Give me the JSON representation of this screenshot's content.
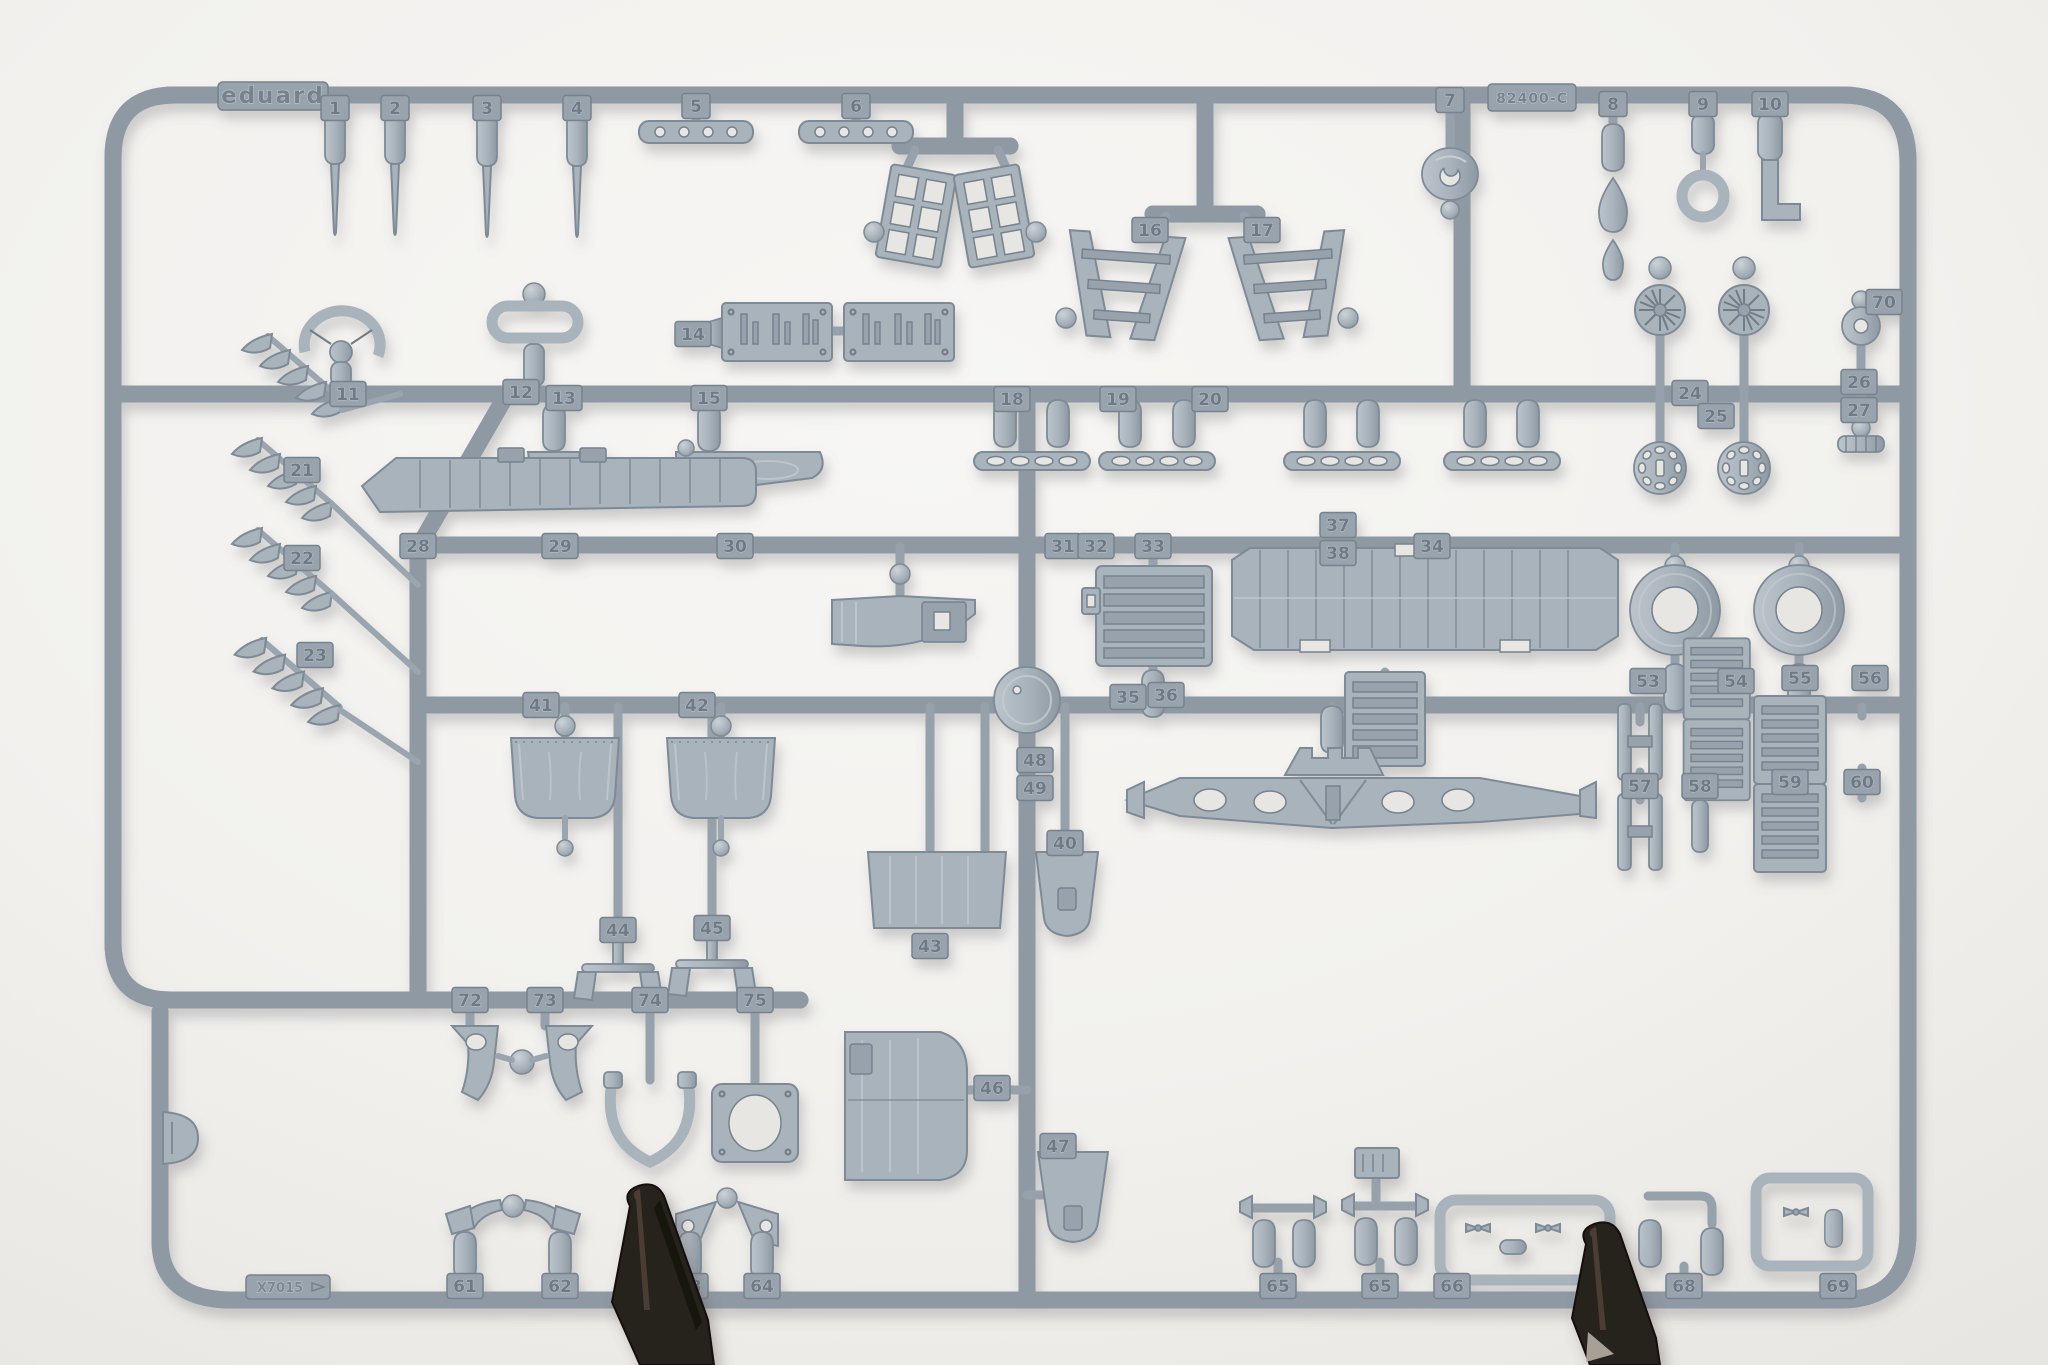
{
  "photo": {
    "background_color": "#f3f2ef",
    "plastic_color": "#a9b3bc",
    "plastic_dark": "#7e8a95",
    "plastic_light": "#c6cdd3",
    "tag_color": "#98a3ad",
    "clip_color": "#26201c"
  },
  "markings": {
    "brand": "eduard",
    "code": "82400-C",
    "mold": "X7015"
  },
  "part_tags": [
    {
      "label": "1",
      "x": 335,
      "y": 108
    },
    {
      "label": "2",
      "x": 395,
      "y": 108
    },
    {
      "label": "3",
      "x": 487,
      "y": 108
    },
    {
      "label": "4",
      "x": 577,
      "y": 108
    },
    {
      "label": "5",
      "x": 696,
      "y": 106
    },
    {
      "label": "6",
      "x": 856,
      "y": 106
    },
    {
      "label": "16",
      "x": 1150,
      "y": 230
    },
    {
      "label": "17",
      "x": 1262,
      "y": 230
    },
    {
      "label": "7",
      "x": 1450,
      "y": 100
    },
    {
      "label": "8",
      "x": 1613,
      "y": 104
    },
    {
      "label": "9",
      "x": 1703,
      "y": 104
    },
    {
      "label": "10",
      "x": 1770,
      "y": 104
    },
    {
      "label": "11",
      "x": 348,
      "y": 394
    },
    {
      "label": "12",
      "x": 521,
      "y": 392
    },
    {
      "label": "13",
      "x": 564,
      "y": 398
    },
    {
      "label": "14",
      "x": 693,
      "y": 334
    },
    {
      "label": "15",
      "x": 709,
      "y": 398
    },
    {
      "label": "18",
      "x": 1012,
      "y": 399
    },
    {
      "label": "19",
      "x": 1118,
      "y": 399
    },
    {
      "label": "20",
      "x": 1210,
      "y": 399
    },
    {
      "label": "24",
      "x": 1690,
      "y": 393
    },
    {
      "label": "25",
      "x": 1716,
      "y": 416
    },
    {
      "label": "26",
      "x": 1859,
      "y": 382
    },
    {
      "label": "27",
      "x": 1859,
      "y": 410
    },
    {
      "label": "70",
      "x": 1884,
      "y": 302
    },
    {
      "label": "21",
      "x": 302,
      "y": 470
    },
    {
      "label": "22",
      "x": 302,
      "y": 558
    },
    {
      "label": "23",
      "x": 315,
      "y": 655
    },
    {
      "label": "28",
      "x": 418,
      "y": 546
    },
    {
      "label": "29",
      "x": 560,
      "y": 546
    },
    {
      "label": "30",
      "x": 735,
      "y": 546
    },
    {
      "label": "31",
      "x": 1063,
      "y": 546
    },
    {
      "label": "32",
      "x": 1096,
      "y": 546
    },
    {
      "label": "33",
      "x": 1153,
      "y": 546
    },
    {
      "label": "34",
      "x": 1432,
      "y": 546
    },
    {
      "label": "37",
      "x": 1338,
      "y": 525
    },
    {
      "label": "38",
      "x": 1338,
      "y": 553
    },
    {
      "label": "41",
      "x": 541,
      "y": 705
    },
    {
      "label": "42",
      "x": 697,
      "y": 705
    },
    {
      "label": "35",
      "x": 1128,
      "y": 697
    },
    {
      "label": "36",
      "x": 1166,
      "y": 695
    },
    {
      "label": "53",
      "x": 1648,
      "y": 681
    },
    {
      "label": "54",
      "x": 1736,
      "y": 681
    },
    {
      "label": "55",
      "x": 1800,
      "y": 678
    },
    {
      "label": "56",
      "x": 1870,
      "y": 678
    },
    {
      "label": "57",
      "x": 1640,
      "y": 786
    },
    {
      "label": "58",
      "x": 1700,
      "y": 786
    },
    {
      "label": "59",
      "x": 1790,
      "y": 782
    },
    {
      "label": "60",
      "x": 1862,
      "y": 782
    },
    {
      "label": "48",
      "x": 1035,
      "y": 760
    },
    {
      "label": "49",
      "x": 1035,
      "y": 788
    },
    {
      "label": "44",
      "x": 618,
      "y": 930
    },
    {
      "label": "45",
      "x": 712,
      "y": 928
    },
    {
      "label": "40",
      "x": 1065,
      "y": 843
    },
    {
      "label": "43",
      "x": 930,
      "y": 946
    },
    {
      "label": "46",
      "x": 992,
      "y": 1088
    },
    {
      "label": "47",
      "x": 1058,
      "y": 1146
    },
    {
      "label": "72",
      "x": 470,
      "y": 1000
    },
    {
      "label": "73",
      "x": 545,
      "y": 1000
    },
    {
      "label": "74",
      "x": 650,
      "y": 1000
    },
    {
      "label": "75",
      "x": 755,
      "y": 1000
    },
    {
      "label": "61",
      "x": 465,
      "y": 1286
    },
    {
      "label": "62",
      "x": 560,
      "y": 1286
    },
    {
      "label": "63",
      "x": 690,
      "y": 1286
    },
    {
      "label": "64",
      "x": 762,
      "y": 1286
    },
    {
      "label": "65",
      "x": 1278,
      "y": 1286
    },
    {
      "label": "65",
      "x": 1380,
      "y": 1286
    },
    {
      "label": "66",
      "x": 1452,
      "y": 1286
    },
    {
      "label": "67",
      "x": 1600,
      "y": 1286
    },
    {
      "label": "68",
      "x": 1684,
      "y": 1286
    },
    {
      "label": "69",
      "x": 1838,
      "y": 1286
    }
  ]
}
